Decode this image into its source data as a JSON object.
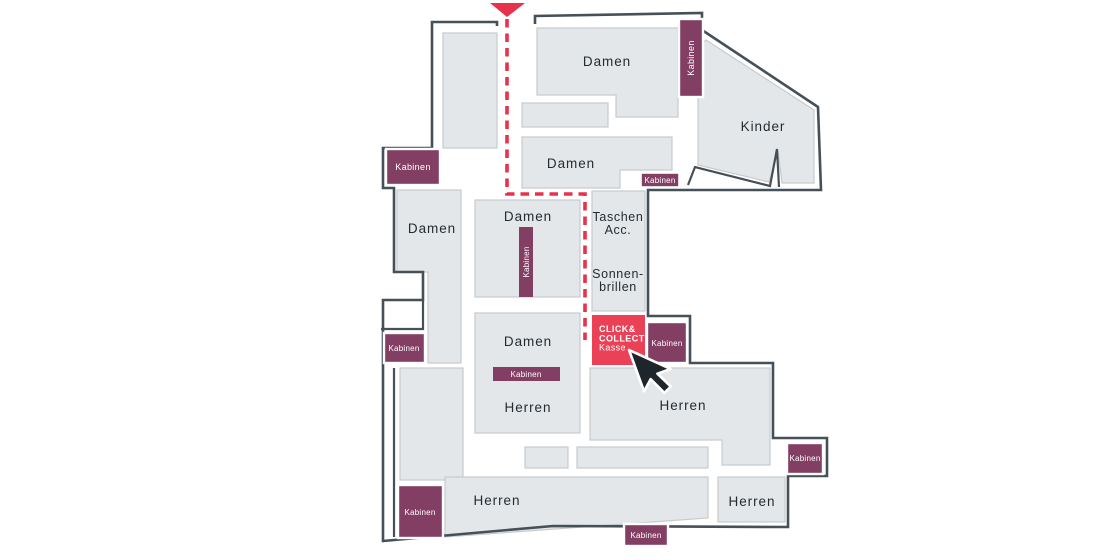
{
  "floorplan": {
    "labels": {
      "damen": "Damen",
      "herren": "Herren",
      "kinder": "Kinder",
      "kabinen": "Kabinen",
      "taschen_line1": "Taschen",
      "taschen_line2": "Acc.",
      "sonnenbrillen_line1": "Sonnen-",
      "sonnenbrillen_line2": "brillen"
    },
    "click_collect": {
      "line1": "CLICK&",
      "line2": "COLLECT",
      "line3": "Kasse"
    },
    "colors": {
      "section_fill": "#e4e7e9",
      "section_border": "#c6cbce",
      "wall": "#455058",
      "kabinen_purple": "#833e63",
      "route_red": "#e8314b",
      "click_collect_red": "#ea4157",
      "label_text": "#242c31",
      "badge_text": "#ffffff",
      "background": "#ffffff"
    }
  }
}
